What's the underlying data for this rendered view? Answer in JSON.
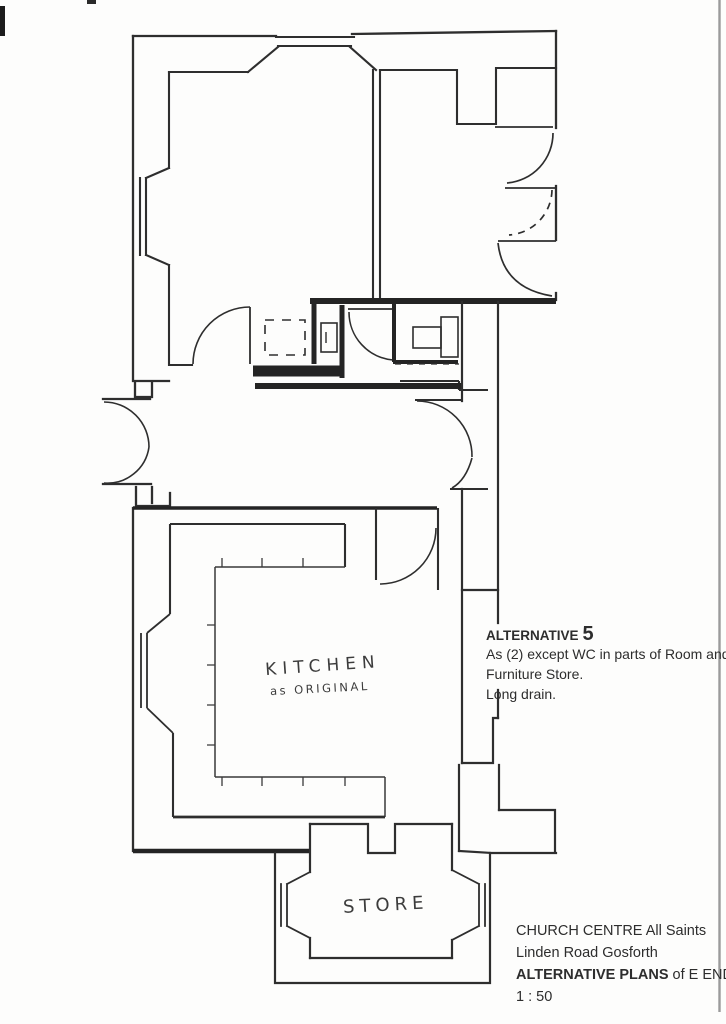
{
  "annotations": {
    "alternative_note": {
      "heading": "ALTERNATIVE",
      "heading_number": "5",
      "lines": [
        "As (2) except WC in parts of Room and",
        "Furniture Store.",
        "Long drain."
      ]
    },
    "title_block": {
      "line1": "CHURCH CENTRE   All Saints",
      "line2": "Linden Road   Gosforth",
      "line3_bold": "ALTERNATIVE PLANS",
      "line3_rest": " of E END",
      "scale": "1 : 50"
    },
    "room_labels": {
      "kitchen": "KITCHEN",
      "kitchen_sub": "as ORIGINAL",
      "store": "STORE"
    }
  },
  "colors": {
    "ink": "#2e2e2e",
    "paper": "#fdfdfc",
    "sheet_edge": "#9b9b9b"
  }
}
